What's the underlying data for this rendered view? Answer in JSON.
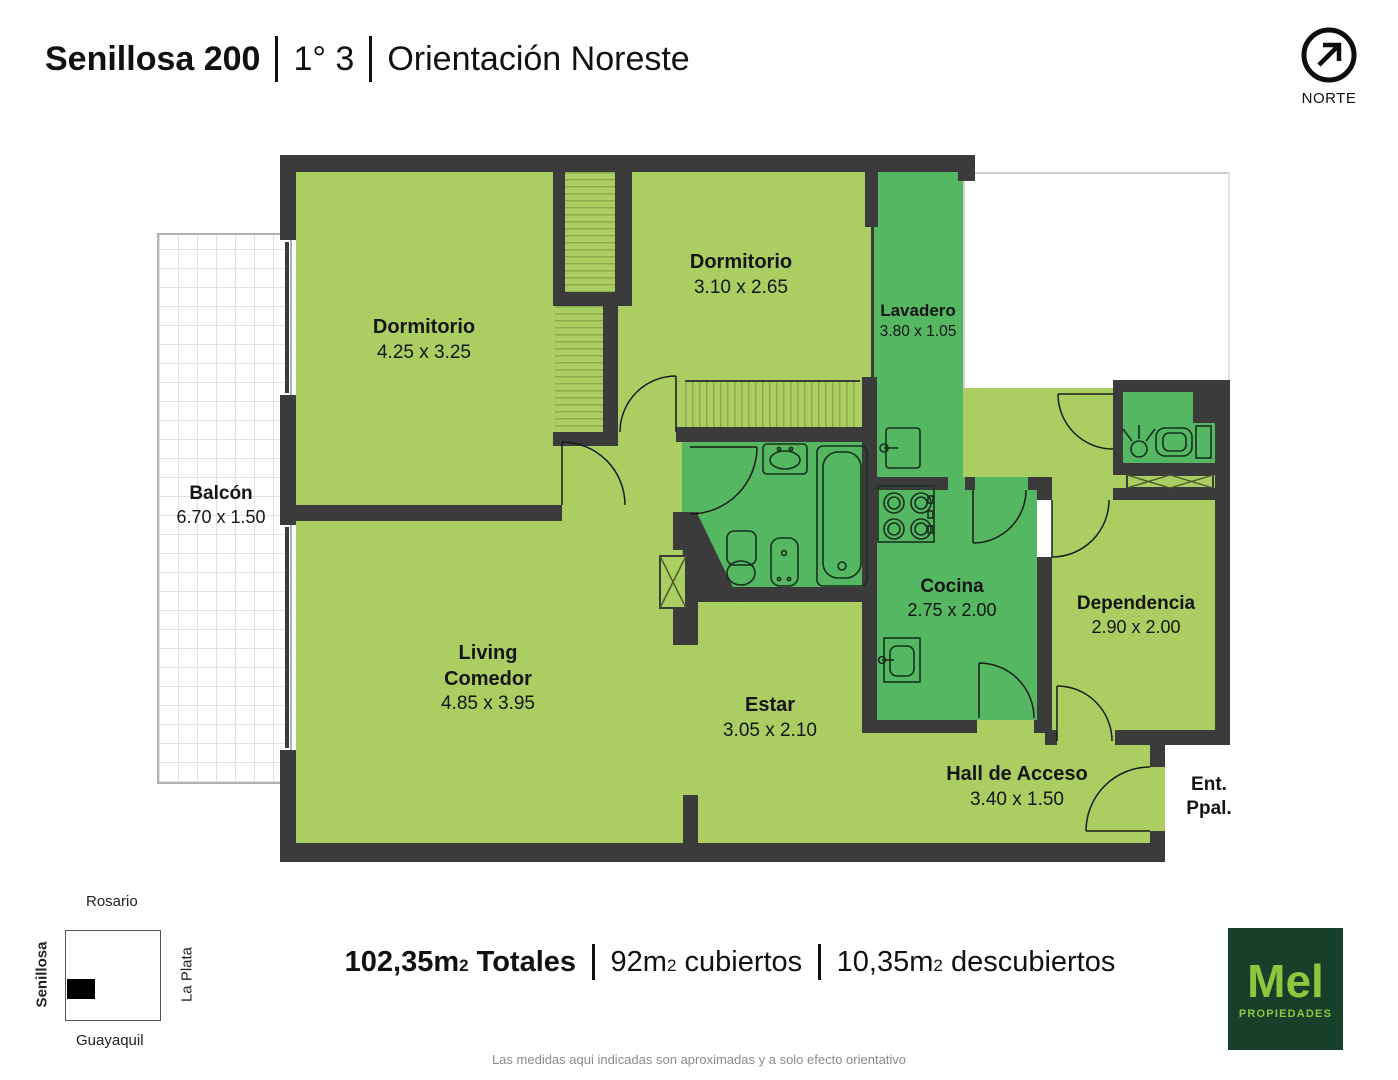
{
  "header": {
    "building": "Senillosa 200",
    "unit": "1° 3",
    "orientation": "Orientación Noreste"
  },
  "north": {
    "label": "NORTE"
  },
  "rooms": {
    "balcon": {
      "name": "Balcón",
      "dims": "6.70 x 1.50"
    },
    "dormitorio1": {
      "name": "Dormitorio",
      "dims": "4.25 x 3.25"
    },
    "dormitorio2": {
      "name": "Dormitorio",
      "dims": "3.10 x 2.65"
    },
    "lavadero": {
      "name": "Lavadero",
      "dims": "3.80 x 1.05"
    },
    "living": {
      "name1": "Living",
      "name2": "Comedor",
      "dims": "4.85 x 3.95"
    },
    "estar": {
      "name": "Estar",
      "dims": "3.05 x 2.10"
    },
    "cocina": {
      "name": "Cocina",
      "dims": "2.75 x 2.00"
    },
    "dependencia": {
      "name": "Dependencia",
      "dims": "2.90 x 2.00"
    },
    "hall": {
      "name": "Hall de Acceso",
      "dims": "3.40 x 1.50"
    },
    "entrada": {
      "line1": "Ent.",
      "line2": "Ppal."
    }
  },
  "map": {
    "north_street": "Rosario",
    "west_street": "Senillosa",
    "east_street": "La Plata",
    "south_street": "Guayaquil"
  },
  "summary": {
    "total": {
      "value": "102,35m",
      "sup": "2",
      "label": "Totales"
    },
    "covered": {
      "value": "92m",
      "sup": "2",
      "label": "cubiertos"
    },
    "uncovered": {
      "value": "10,35m",
      "sup": "2",
      "label": "descubiertos"
    }
  },
  "logo": {
    "brand": "Mel",
    "tagline": "PROPIEDADES"
  },
  "disclaimer": "Las medidas aqui indicadas son aproximadas y a solo efecto orientativo",
  "colors": {
    "room_light": "#abce63",
    "room_wet": "#56b762",
    "wall": "#3b3b3b",
    "logo_bg": "#17402a",
    "logo_text": "#8dc63f"
  }
}
